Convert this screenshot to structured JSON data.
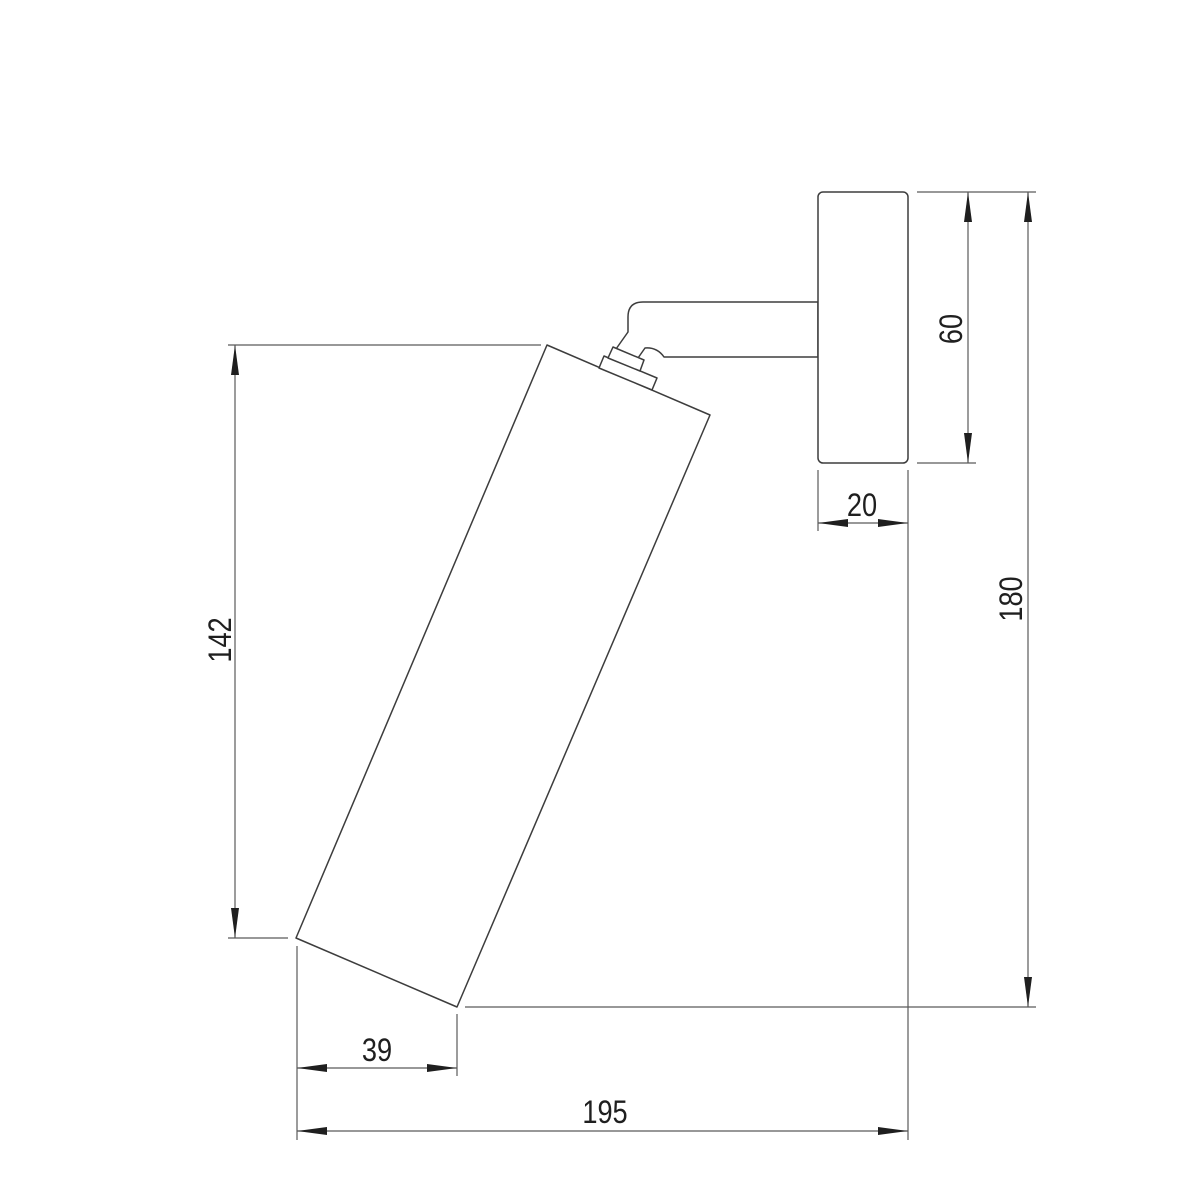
{
  "diagram": {
    "background_color": "#ffffff",
    "outline_color": "#3d3d3d",
    "dimension_line_color": "#5a5a5a",
    "text_color": "#1f1f1f",
    "dimensions": {
      "body_length": "142",
      "body_end_offset": "39",
      "overall_depth": "195",
      "backplate_depth": "20",
      "backplate_height": "60",
      "overall_height": "180"
    }
  }
}
